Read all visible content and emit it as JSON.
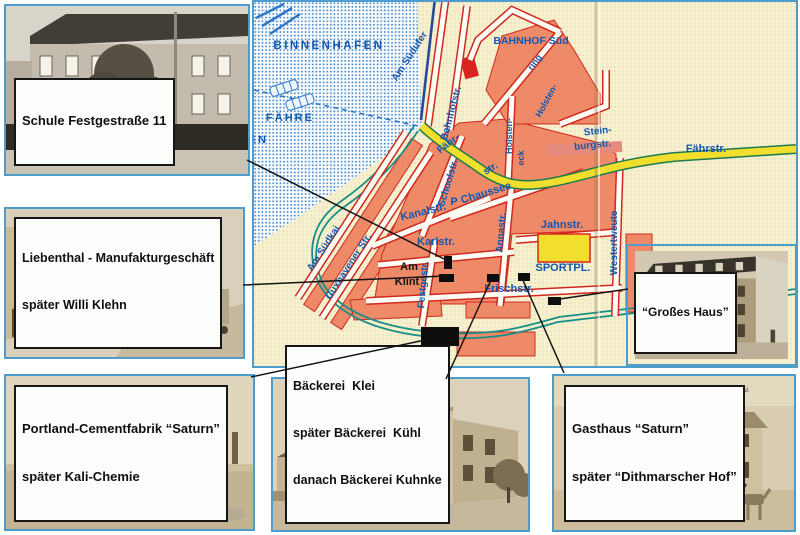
{
  "photos": {
    "schule": {
      "label": "Schule Festgestraße 11"
    },
    "liebenthal": {
      "line1": "Liebenthal - Manufakturgeschäft",
      "line2": "später Willi Klehn",
      "caption_a": "Brunsbüttelkoog",
      "caption_b": "Feststr."
    },
    "cement": {
      "line1": "Portland-Cementfabrik “Saturn”",
      "line2": "später Kali-Chemie",
      "caption_a": "Brunsbüttelkoog",
      "caption_b": "Cementfabrik Saturn"
    },
    "baeckerei": {
      "line1": "Bäckerei  Klei",
      "line2": "später Bäckerei  Kühl",
      "line3": "danach Bäckerei Kuhnke"
    },
    "gasthaus": {
      "line1": "Gasthaus “Saturn”",
      "line2": "später “Dithmarscher Hof”",
      "caption": "Brunsbüttelkoog.  Gruß vom Gasthaus „Saturn.“   Inh.: Jac. Reinhold."
    },
    "grosses_haus": {
      "label": "“Großes Haus”"
    }
  },
  "map": {
    "place_labels": {
      "binnenhafen": "BINNENHAFEN",
      "faehre": "FÄHRE",
      "hafen": "HAFEN",
      "bahnhof_sued": "BAHNHOF Süd",
      "sportpl": "SPORTPL.",
      "parking": "P"
    },
    "street_labels": {
      "am_suedufer": "Am Südufer",
      "bahnhofstr": "Bahnhofstr.",
      "holstenring_a": "ring",
      "holstenring_b": "Holsten-",
      "holsteneck_a": "Holsten-",
      "holsteneck_b": "eck",
      "steinburgstr_a": "Stein-",
      "steinburgstr_b": "burgstr.",
      "faehrstr_diag_a": "Fähr-",
      "faehrstr_diag_b": "str.",
      "faehrstr": "Fährstr.",
      "am_suedkai": "Am Südkai",
      "cuxhavener_str": "Cuxhavener Str.",
      "kanalstr": "Kanalstr.",
      "schoolstr": "Schoolstr.",
      "chaussee": "Chaussee",
      "annastr": "Annastr.",
      "jahnstr": "Jahnstr.",
      "karlstr": "Karlstr.",
      "festgestr": "Festgestr.",
      "am_klint_a": "Am",
      "am_klint_b": "Klint",
      "frischstr": "Frischstr.",
      "westertweute": "Westertweute"
    },
    "colors": {
      "water_dot": "#3b82c4",
      "land": "#f4eecd",
      "block": "#ef8a68",
      "street_casing": "#d0281e",
      "road_yellow": "#f2de2c",
      "road_casing": "#1c7a50",
      "canal": "#178f86",
      "text_blue": "#1457ae",
      "marker": "#0d0d0d",
      "frame_blue": "#4c9dcb"
    }
  }
}
